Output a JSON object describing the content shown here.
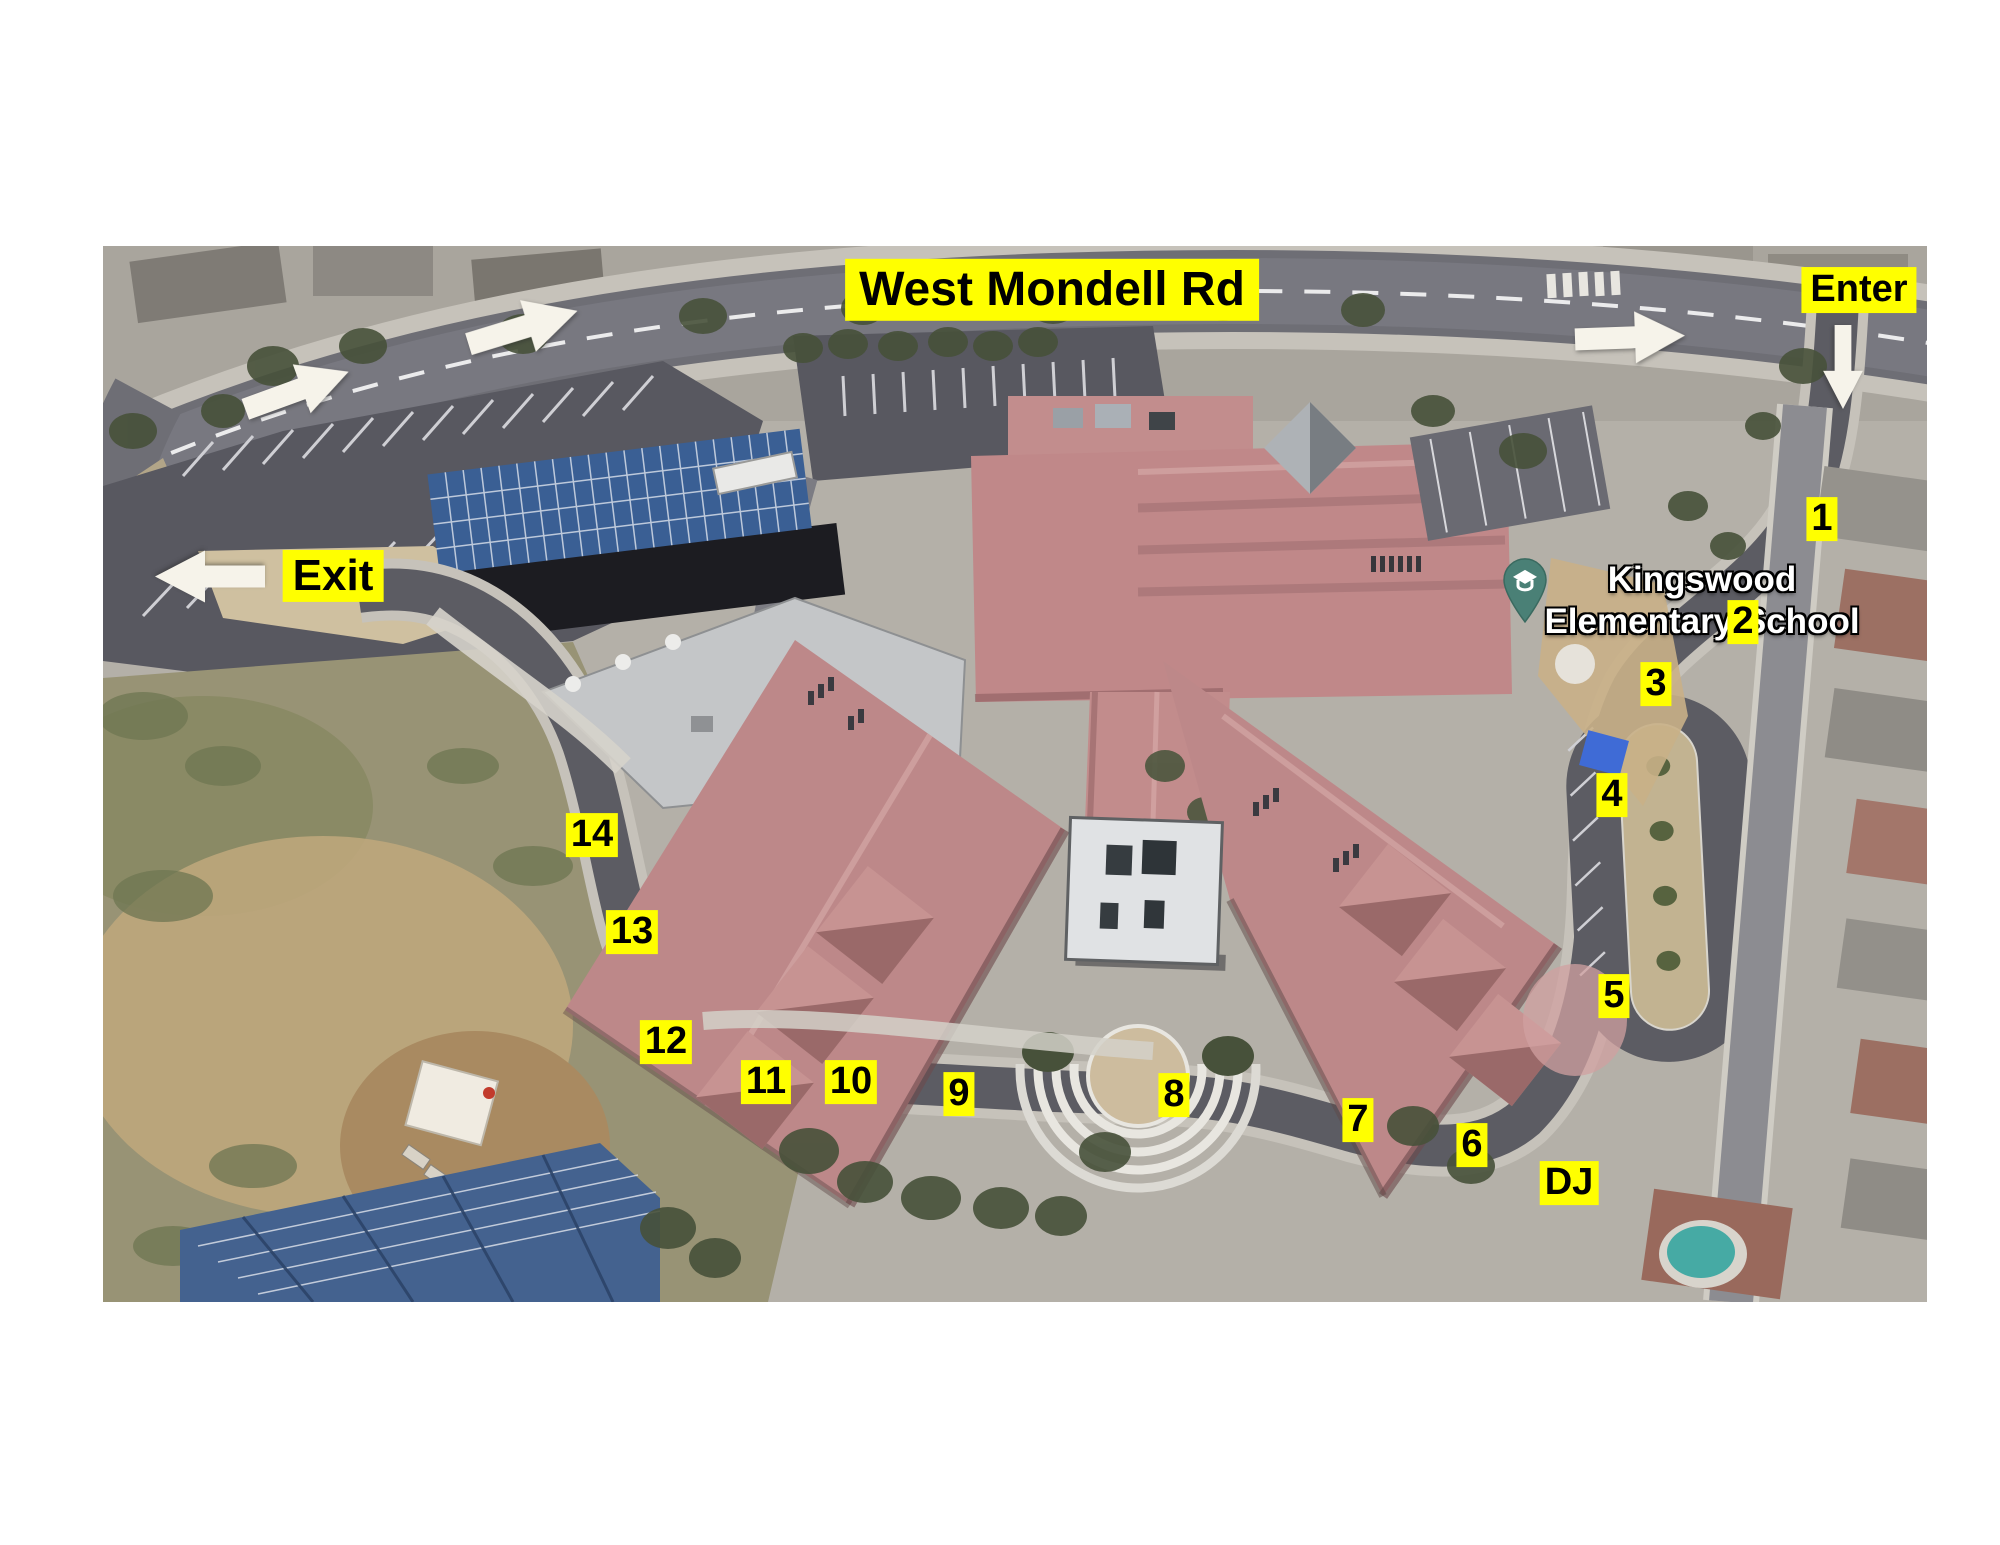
{
  "labels": {
    "road": "West Mondell Rd",
    "enter": "Enter",
    "exit": "Exit",
    "school_line1": "Kingswood",
    "school_line2": "Elementary School"
  },
  "colors": {
    "highlight": "#ffff00",
    "label_text": "#000000",
    "map_label_text": "#ffffff",
    "arrow_fill": "#f6f3ea",
    "pin_fill": "#4a8076"
  },
  "markers": [
    {
      "label": "1",
      "x": 1822,
      "y": 519
    },
    {
      "label": "2",
      "x": 1743,
      "y": 622
    },
    {
      "label": "3",
      "x": 1656,
      "y": 684
    },
    {
      "label": "4",
      "x": 1612,
      "y": 795
    },
    {
      "label": "5",
      "x": 1614,
      "y": 996
    },
    {
      "label": "6",
      "x": 1472,
      "y": 1145
    },
    {
      "label": "7",
      "x": 1358,
      "y": 1120
    },
    {
      "label": "8",
      "x": 1174,
      "y": 1095
    },
    {
      "label": "9",
      "x": 959,
      "y": 1094
    },
    {
      "label": "10",
      "x": 851,
      "y": 1082
    },
    {
      "label": "11",
      "x": 766,
      "y": 1082
    },
    {
      "label": "12",
      "x": 666,
      "y": 1042
    },
    {
      "label": "13",
      "x": 632,
      "y": 932
    },
    {
      "label": "14",
      "x": 592,
      "y": 835
    },
    {
      "label": "DJ",
      "x": 1569,
      "y": 1183
    }
  ],
  "arrows": [
    {
      "name": "traffic-arrow-west-lower",
      "x": 297,
      "y": 390,
      "rotation": -20,
      "length": 110
    },
    {
      "name": "traffic-arrow-west-upper",
      "x": 523,
      "y": 327,
      "rotation": -17,
      "length": 114
    },
    {
      "name": "traffic-arrow-east",
      "x": 1630,
      "y": 337,
      "rotation": -2,
      "length": 110
    },
    {
      "name": "enter-arrow-down",
      "x": 1843,
      "y": 367,
      "rotation": 90,
      "length": 84
    },
    {
      "name": "exit-arrow-left",
      "x": 210,
      "y": 576,
      "rotation": 180,
      "length": 110
    }
  ]
}
